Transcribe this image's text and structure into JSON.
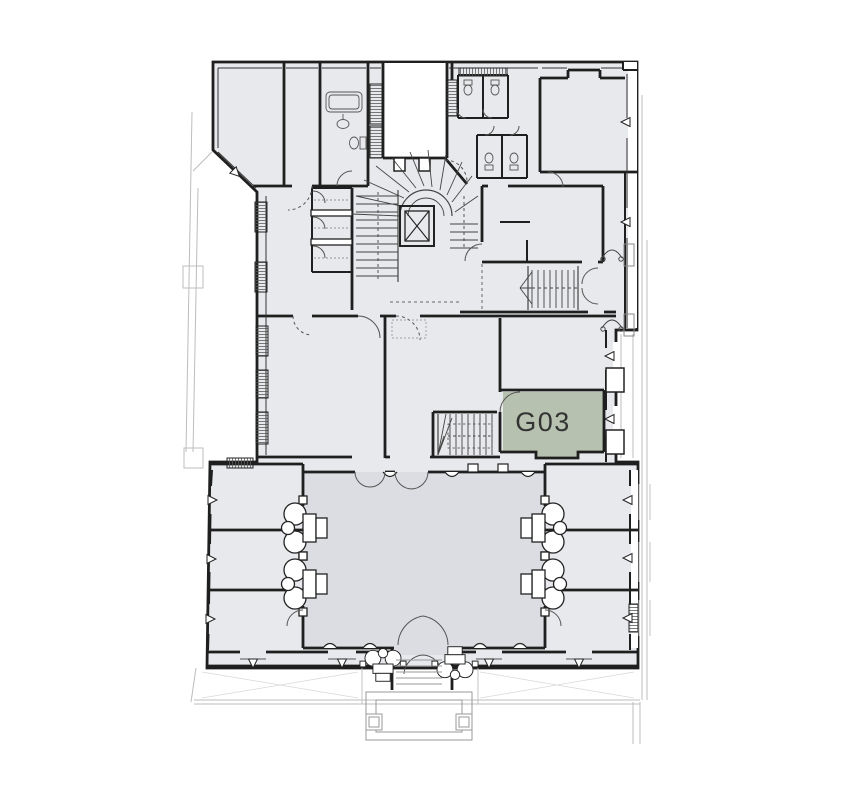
{
  "plan": {
    "highlighted_unit": {
      "label": "G03",
      "fill": "#b6c1af"
    },
    "colors": {
      "background": "#ffffff",
      "room_fill": "#e8e9ec",
      "hall_fill": "#dcdde3",
      "wall": "#1f1f1f",
      "detail_line": "#555555",
      "faint_line": "#bdbdbd",
      "label_text": "#333333"
    }
  }
}
